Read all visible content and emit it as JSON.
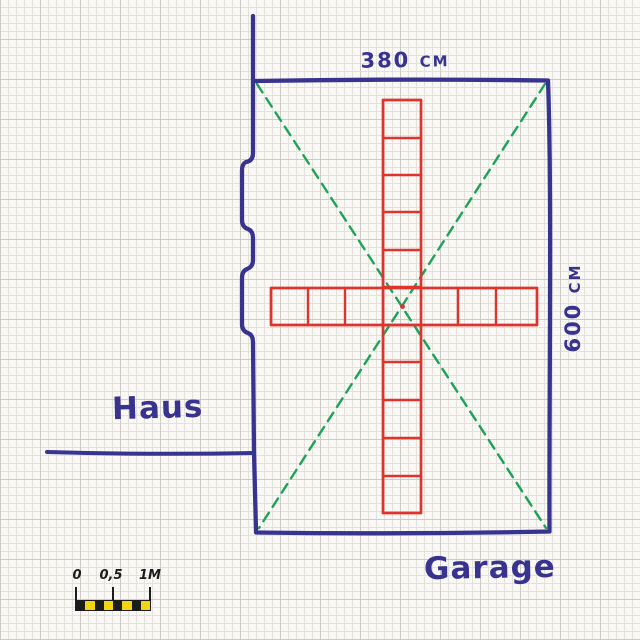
{
  "title": "Hand-drawn site sketch of house and garage on graph paper",
  "colors": {
    "ink_blue": "#38338f",
    "ink_red": "#dd352e",
    "ink_green": "#1ea257",
    "paper": "#f9f8f4",
    "grid_minor": "#e3e1dc",
    "grid_major": "#cecbc6",
    "scale_black": "#1c1c1c",
    "scale_yellow": "#f2d511"
  },
  "labels": {
    "house": "Haus",
    "garage": "Garage",
    "width_dimension": "380 cm",
    "height_dimension": "600 cm"
  },
  "diagram": {
    "garage_width_cm": 380,
    "garage_depth_cm": 600,
    "tile_cross": {
      "shape": "cross of square tiles",
      "vertical_tiles": 11,
      "horizontal_tiles": 7,
      "ink": "red"
    },
    "diagonals": "two dashed green corner-to-corner guide lines",
    "wall_side": "house wall on left with two door/jamb offsets"
  },
  "scale_bar": {
    "labels": {
      "zero": "0",
      "half": "0,5",
      "one": "1M"
    },
    "segments": [
      "black",
      "yellow",
      "black",
      "yellow",
      "black",
      "yellow",
      "black",
      "yellow"
    ]
  }
}
